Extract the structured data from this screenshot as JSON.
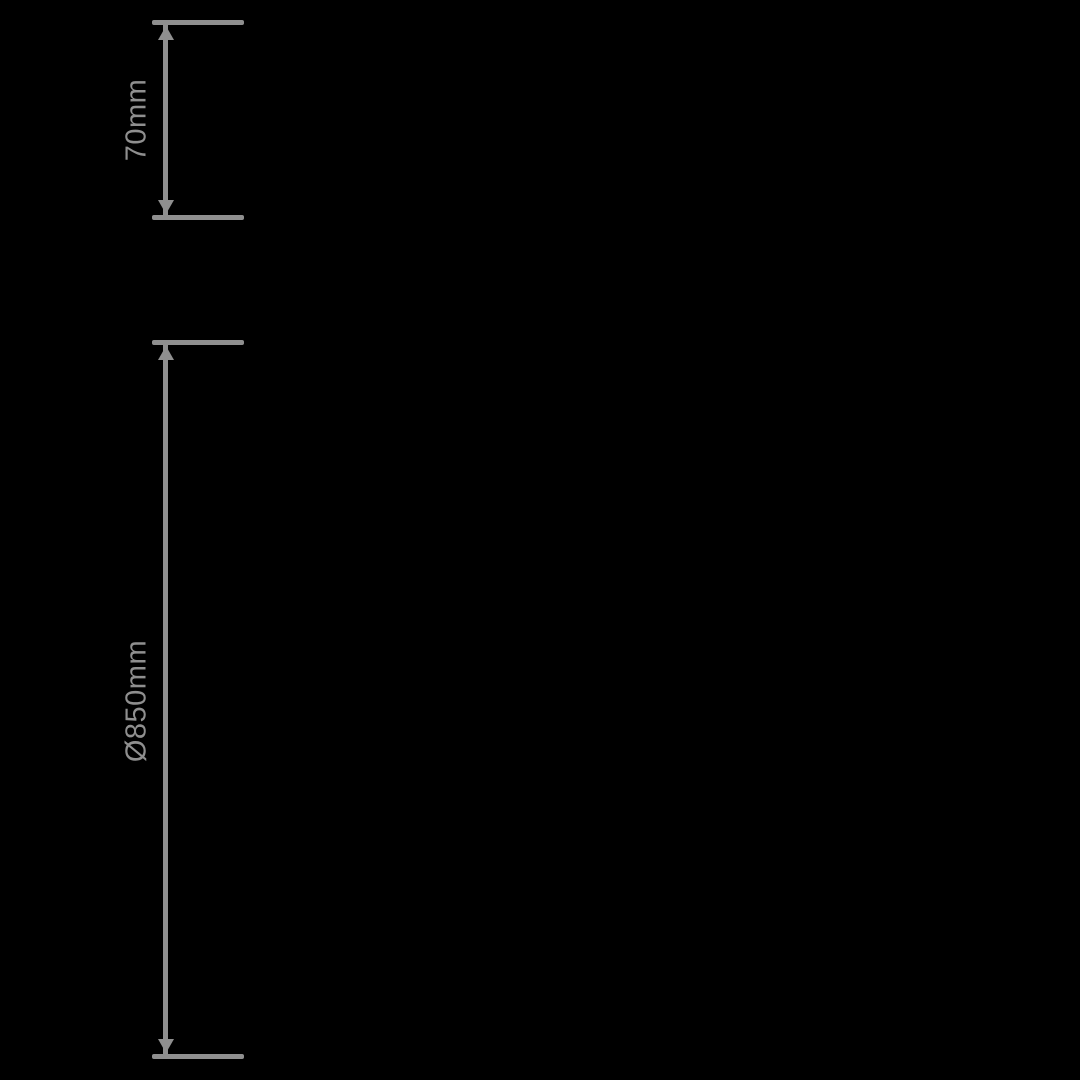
{
  "diagram": {
    "type": "product-dimension-drawing",
    "background_color": "#000000",
    "annotation_color": "#8f8f8f",
    "dimensions": [
      {
        "label": "70mm"
      },
      {
        "label": "Ø850mm"
      }
    ]
  }
}
